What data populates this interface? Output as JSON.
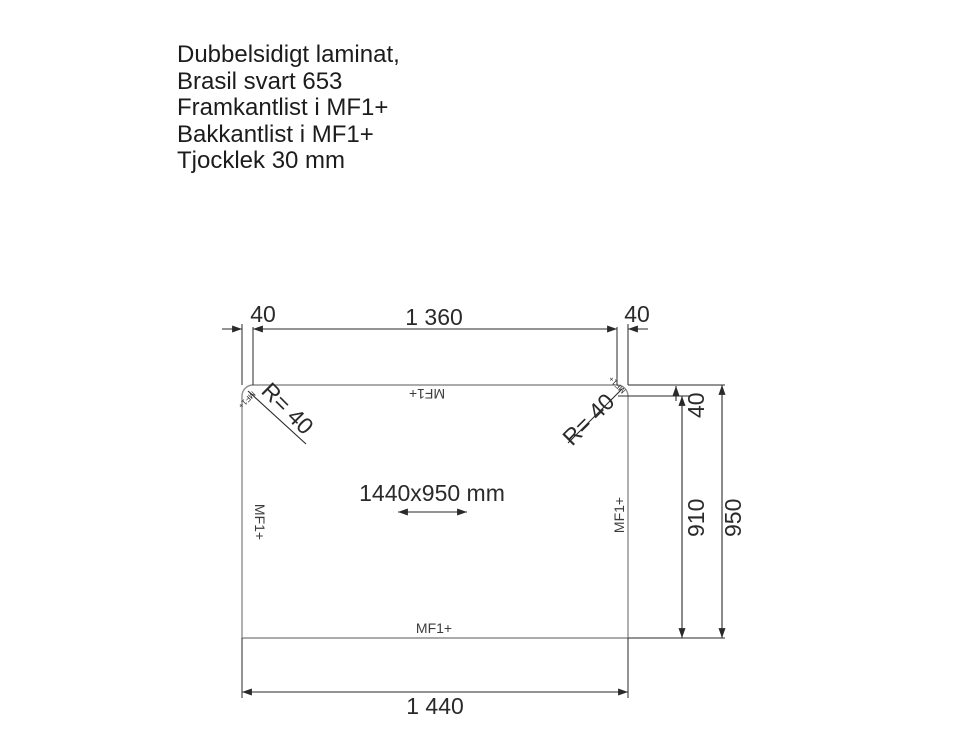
{
  "title_block": {
    "line1": "Dubbelsidigt laminat,",
    "line2": "Brasil svart 653",
    "line3": "Framkantlist i MF1+",
    "line4": "Bakkantlist i MF1+",
    "line5": "Tjocklek 30 mm"
  },
  "drawing": {
    "dimensions": {
      "top_left_corner_width": "40",
      "top_straight_width": "1 360",
      "top_right_corner_width": "40",
      "right_corner_height": "40",
      "right_straight_height": "910",
      "right_total_height": "950",
      "bottom_total_width": "1 440",
      "panel_size_label": "1440x950 mm",
      "corner_radius_left": "R= 40",
      "corner_radius_right": "R= 40"
    },
    "edge_bands": {
      "top": "MF1+",
      "bottom": "MF1+",
      "left": "MF1+",
      "right": "MF1+",
      "corner_left": "MF1+",
      "corner_right": "MF1+"
    },
    "colors": {
      "ink": "#2a2a2a",
      "panel_outline": "#8f8f8f",
      "background": "#ffffff"
    }
  }
}
